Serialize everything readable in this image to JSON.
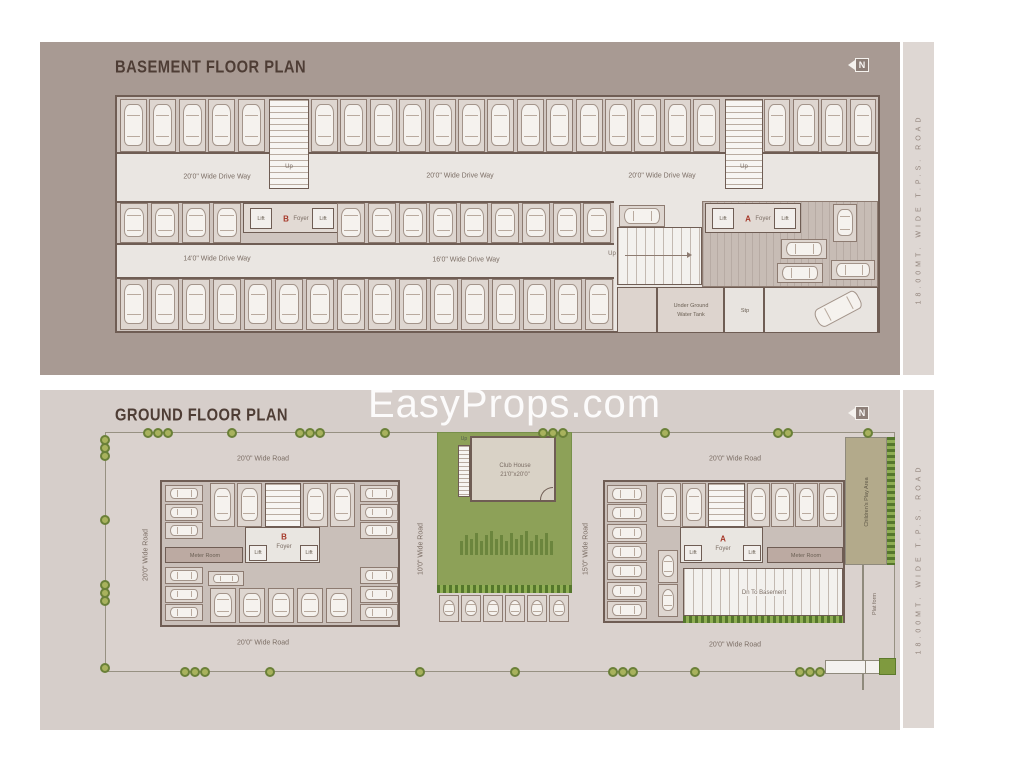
{
  "watermark_text": "EasyProps.com",
  "side_road_label": "18.00MT. WIDE T.P.S. ROAD",
  "colors": {
    "basement_panel": "#a89a93",
    "ground_panel": "#d6ceca",
    "garden_green": "#8da158",
    "accent_red": "#a6392a",
    "hedge_green": "#55772c",
    "play_area_khaki": "#b3aa8b"
  },
  "basement": {
    "title": "BASEMENT FLOOR PLAN",
    "north": "N",
    "labels": {
      "driveway_top_left": "20'0\" Wide Drive Way",
      "driveway_top_center": "20'0\" Wide Drive Way",
      "driveway_top_right": "20'0\" Wide Drive Way",
      "driveway_mid_left": "14'0\" Wide Drive Way",
      "driveway_mid_center": "16'0\" Wide Drive Way",
      "stair1_up": "Up",
      "stair2_up": "Up",
      "ramp_up": "Up",
      "water_tank_1": "Under Ground",
      "water_tank_2": "Water Tank",
      "stp": "Stp"
    },
    "core_b": {
      "lift": "Lift",
      "block": "B",
      "foyer": "Foyer",
      "lift2": "Lift"
    },
    "core_a": {
      "lift": "Lift",
      "block": "A",
      "foyer": "Foyer",
      "lift2": "Lift"
    }
  },
  "ground": {
    "title": "GROUND FLOOR PLAN",
    "north": "N",
    "roads": {
      "top_left": "20'0\" Wide Road",
      "top_right": "20'0\" Wide Road",
      "bottom_left": "20'0\" Wide Road",
      "bottom_right": "20'0\" Wide Road",
      "left": "20'0\" Wide Road",
      "center_left": "10'0\" Wide Road",
      "center_right": "15'0\" Wide Road"
    },
    "club_house": {
      "name": "Club House",
      "size": "21'0\"x20'0\"",
      "stair_up": "Up"
    },
    "building_b": {
      "up": "Up",
      "dn": "Dn",
      "block": "B",
      "foyer": "Foyer",
      "lift": "Lift",
      "lift2": "Lift",
      "meter_room": "Meter Room"
    },
    "building_a": {
      "up": "Up",
      "dn": "Dn",
      "block": "A",
      "foyer": "Foyer",
      "lift": "Lift",
      "lift2": "Lift",
      "meter_room": "Meter Room",
      "ramp": "Dn To Basement"
    },
    "play_area": "Children's Play Area",
    "platform": "Plat form"
  }
}
